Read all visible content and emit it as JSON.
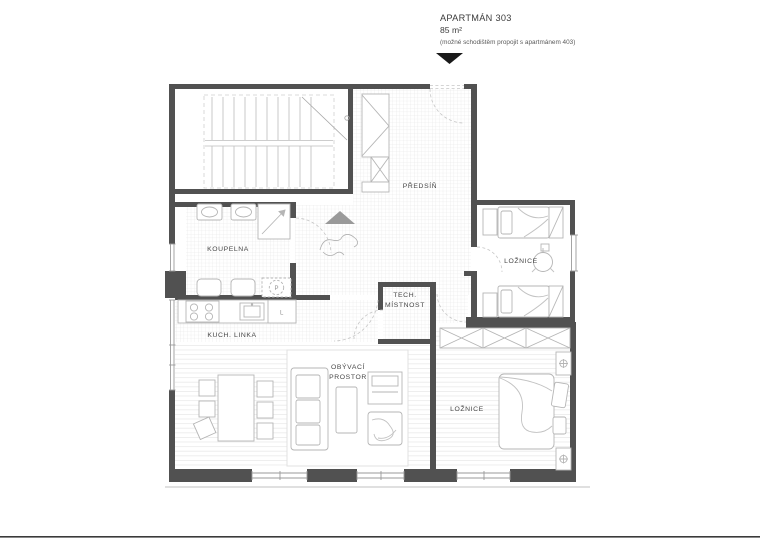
{
  "header": {
    "title": "APARTMÁN 303",
    "area": "85 m²",
    "note": "(možné schodištěm propojit s apartmánem 403)"
  },
  "rooms": {
    "hallway": "PŘEDSÍŇ",
    "bathroom": "KOUPELNA",
    "bedroom1": "LOŽNICE",
    "tech1": "TECH.",
    "tech2": "MÍSTNOST",
    "kitchen": "KUCH. LINKA",
    "living1": "OBÝVACÍ",
    "living2": "PROSTOR",
    "bedroom2": "LOŽNICE"
  },
  "appliances": {
    "washer": "P",
    "fridge": "L"
  },
  "colors": {
    "wall": "#515151",
    "furniture": "#b5b5b5",
    "floor_pattern": "#e4e4e4",
    "entrance_marker": "#1a1a1a",
    "direction_triangle": "#9a9a9a"
  }
}
